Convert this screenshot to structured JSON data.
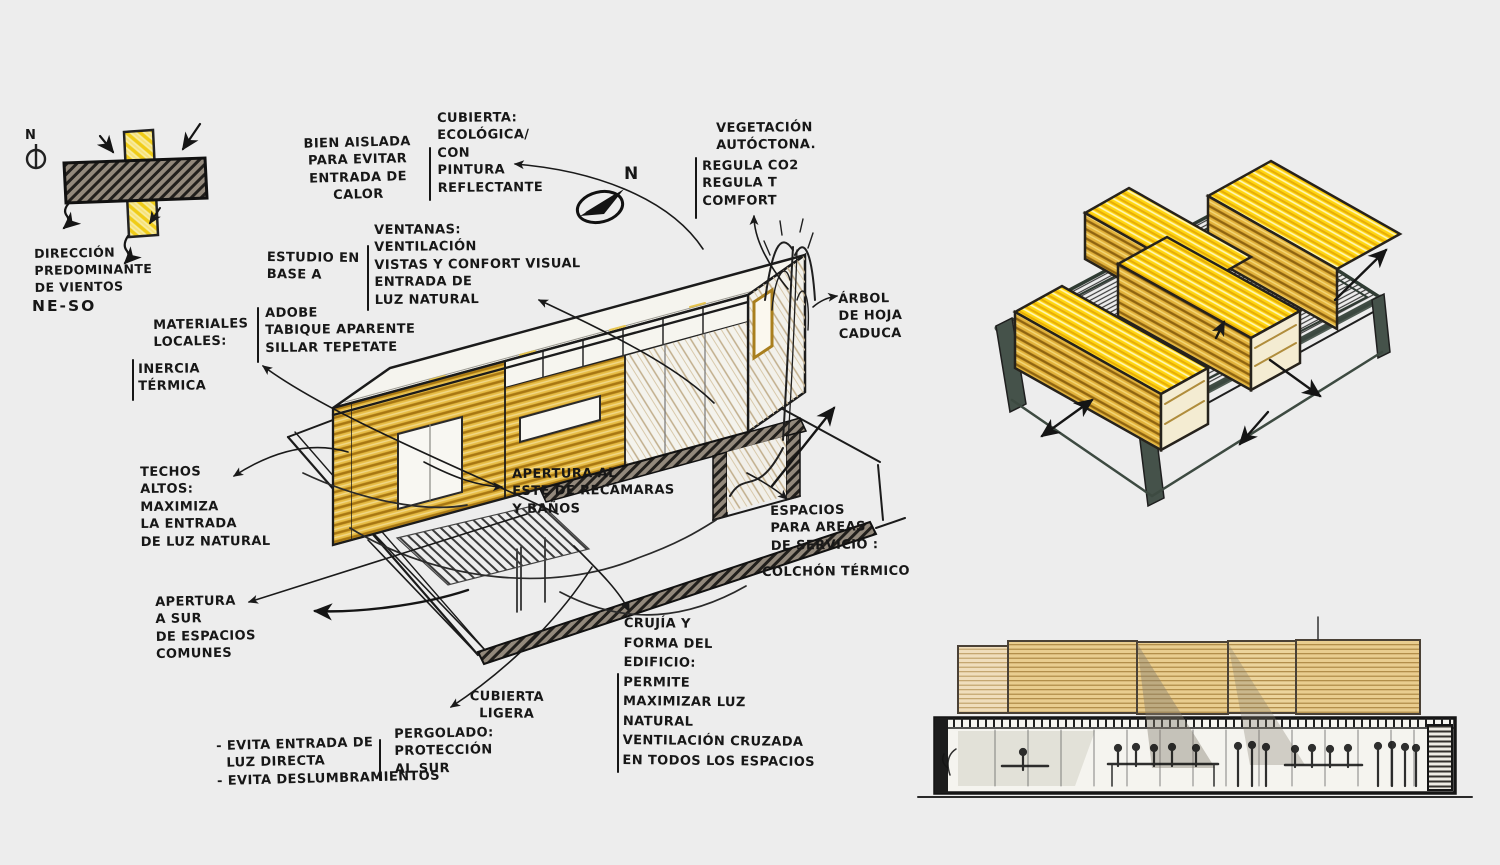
{
  "canvas": {
    "background": "#ededed",
    "ink": "#1b1b1b"
  },
  "palette": {
    "adobe_gold": "#d9a01b",
    "bright_yellow": "#ffd60f",
    "tan_panel": "#e9cd8f",
    "frame_green": "#3f4c43",
    "hatch_dark": "#211f1c"
  },
  "labels": {
    "compass_n": {
      "text": "N"
    },
    "wind_direction": {
      "text": "DIRECCIÓN\nPREDOMINANTE\nDE VIENTOS"
    },
    "wind_range": {
      "text": "NE-SO"
    },
    "bien_aislada": {
      "text": "BIEN AISLADA\nPARA EVITAR\nENTRADA DE\nCALOR"
    },
    "cubierta_ecologica": {
      "text": "CUBIERTA:\nECOLÓGICA/\nCON\nPINTURA\nREFLECTANTE"
    },
    "ventanas": {
      "text": "VENTANAS:\nVENTILACIÓN\nVISTAS Y CONFORT VISUAL\nENTRADA DE\nLUZ NATURAL"
    },
    "estudio": {
      "text": "ESTUDIO EN\nBASE A"
    },
    "materiales": {
      "text": "MATERIALES\nLOCALES:"
    },
    "materiales_lista": {
      "text": "ADOBE\nTABIQUE APARENTE\nSILLAR TEPETATE"
    },
    "inercia": {
      "text": "INERCIA\nTÉRMICA"
    },
    "techos": {
      "text": "TECHOS\nALTOS:\nMAXIMIZA\nLA ENTRADA\nDE LUZ NATURAL"
    },
    "apertura_sur": {
      "text": "APERTURA\nA SUR\nDE ESPACIOS\nCOMUNES"
    },
    "apertura_este": {
      "text": "APERTURA AL\nESTE DE RECÁMARAS\nY BAÑOS"
    },
    "espacios_servicio": {
      "text": "ESPACIOS\nPARA AREAS\nDE SERVICIO :"
    },
    "colchon": {
      "text": "COLCHÓN TÉRMICO"
    },
    "vegetacion": {
      "text": "VEGETACIÓN\nAUTÓCTONA."
    },
    "vegetacion_lista": {
      "text": "REGULA CO2\nREGULA T\nCOMFORT"
    },
    "arbol": {
      "text": "ÁRBOL\nDE HOJA\nCADUCA"
    },
    "north": {
      "text": "N"
    },
    "cubierta_ligera": {
      "text": "CUBIERTA\nLIGERA"
    },
    "pergolado": {
      "text": "PERGOLADO:\nPROTECCIÓN\nAL SUR"
    },
    "evita": {
      "text": "- EVITA ENTRADA DE\n  LUZ DIRECTA\n- EVITA DESLUMBRAMIENTOS"
    },
    "crujia": {
      "text": "CRUJÍA Y\nFORMA DEL\nEDIFICIO:\nPERMITE\nMAXIMIZAR LUZ\nNATURAL\nVENTILACIÓN CRUZADA\nEN TODOS LOS ESPACIOS"
    }
  },
  "icons": {
    "compass": "circle-with-needle",
    "north_arrow": "filled-pointer-ellipse",
    "flow_arrow": "hand-drawn-arrow"
  }
}
